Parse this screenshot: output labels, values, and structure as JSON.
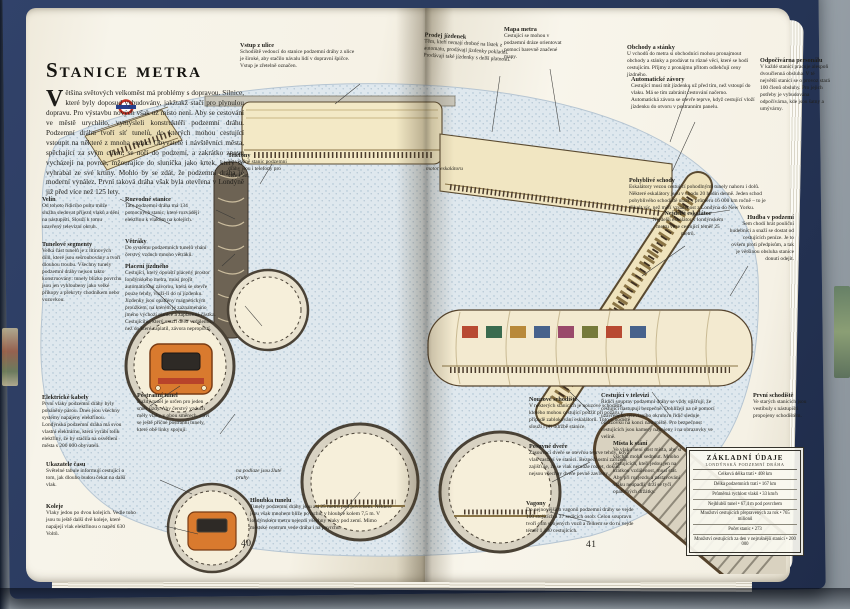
{
  "book": {
    "title": "Stanice metra",
    "intro": "Většina světových velkoměst má problémy s dopravou. Silnice, které byly doposud vybudovány, jakžtakž stačí pro plynulou dopravu. Pro výstavbu nových však už místo není. Aby se cestování ve městě urychlilo, vymysleli konstruktéři podzemní dráhu. Podzemní dráhu tvoří síť tunelů, do kterých mohou cestující vstoupit na některé z mnoha stanic. Obyvatelé i návštěvníci města, spěchající za svým cílem, se noří do podzemí, a zakrátko znovu vycházejí na povrch, mžourajíce do sluníčka jako krtek, který se vyhrabal ze své krtiny. Mohlo by se zdát, že podzemní dráha je moderní vynález. První taková dráha však byla otevřena v Londýně již před více než 125 lety.",
    "page_left": "40",
    "page_right": "41"
  },
  "annotations": {
    "vstup_z_ulice": {
      "heading": "Vstup z ulice",
      "body": "Schodiště vedoucí do stanice podzemní dráhy z ulice je široké, aby stačilo návalu lidí v dopravní špičce. Vstup je zřetelně označen."
    },
    "prodej_jizdenek": {
      "heading": "Prodej jízdenek",
      "body": "Těm, kteří nemají drobné na lístek z automatu, prodávají jízdenky pokladní. Prodávají také jízdenky s delší platností."
    },
    "mapa_metra": {
      "heading": "Mapa metra",
      "body": "Cestující se mohou v podzemní dráze orientovat pomocí barevně značené mapy."
    },
    "obchody_a_stanky": {
      "heading": "Obchody a stánky",
      "body": "U vchodů do metra si obchodníci mohou pronajmout obchody a stánky a prodávat tu různé věci, které se hodí cestujícím. Příjmy z pronájmu přitom odlehčují ceny jízdného."
    },
    "automaticke_zavory": {
      "heading": "Automatické závory",
      "body": "Cestující musí mít jízdenku už před tím, než vstoupí do vlaku. Má se tím zabránit cestování načerno. Automatická závora se otevře teprve, když cestující vloží jízdenku do otvoru v postranním panelu."
    },
    "odpocivarna_personalu": {
      "heading": "Odpočívárna personálu",
      "body": "V každé stanici pracuje alespoň dvoučlenná obsluha. V té největší stanici se o provoz stará 100 členů obsluhy. Pro jejich potřeby je vybudována odpočívárna, kde jsou šatny a umývárny."
    },
    "telefony": {
      "heading": "Telefony",
      "body": "Ve většině stanic podzemní dráhy jsou i telefony pro veřejnost."
    },
    "velin": {
      "heading": "Velín",
      "body": "Od tohoto řídicího pultu může služba sledovat příjezd vlaků a dění na nástupišti. Slouží k tomu uzavřený televizní okruh."
    },
    "rozvodne_stanice": {
      "heading": "Rozvodné stanice",
      "body": "Tato podzemní dráha má 134 pomocných stanic, které rozvádějí elektřinu k vlakům na kolejích."
    },
    "vetraky": {
      "heading": "Větráky",
      "body": "Do systému podzemních tunelů vhání čerstvý vzduch mnoho větráků."
    },
    "tunelove_segmenty": {
      "heading": "Tunelové segmenty",
      "body": "Velká část tunelů je z litinových dílů, které jsou sešroubovány a tvoří dlouhou troubu. Všechny tunely podzemní dráhy nejsou takto konstruovány: tunely blízko povrchu jsou jen vyhloubeny jako velké příkopy a překryty chodníkem nebo vozovkou."
    },
    "placeni_jizdneho": {
      "heading": "Placení jízdného",
      "body": "Cestující, který opouští placený prostor londýnského metra, musí projít automatickou závorou, která se otevře pouze tehdy, vloží-li do ní jízdenku. Jízdenky jsou opatřeny magnetickým proužkem, na kterém je zaznamenáno jméno výchozí stanice a zaplacená částka. Cestujícího, který urazil delší vzdálenost, než do které zaplatil, závora nepropustí."
    },
    "pohyblive_schody": {
      "heading": "Pohyblivé schody",
      "body": "Eskalátory vezou cestující pohodlnými tunely nahoru i dolů. Některé eskalátory jsou v chodu 20 hodin denně. Jeden schod pohyblivého schodiště urazí v průměru 16 000 km ročně – to je třikrát víc, než měří vzdálenost z Londýna do New Yorku."
    },
    "nejdelsi_eskalator": {
      "heading": "Nejdelší eskalátor",
      "body": "Nejdelší eskalátor v londýnském metru veze cestující téměř 25 metrů."
    },
    "hudba_v_podzemi": {
      "heading": "Hudba v podzemí",
      "body": "Sem chodí hrát pouliční hudebníci a snaží se dostat od cestujících peníze. Je to ovšem proti předpisům, a tak je většinou obsluha stanice donutí odejít."
    },
    "elektricke_kabely": {
      "heading": "Elektrické kabely",
      "body": "První vlaky podzemní dráhy byly poháněny párou. Dnes jsou všechny systémy napájeny elektřinou. Londýnská podzemní dráha má svou vlastní elektrárnu, která vyrábí tolik elektřiny, že by stačila na osvětlení města s 200 000 obyvateli."
    },
    "postranni_tunel": {
      "heading": "Postranní tunel",
      "body": "Každý tunel je určen pro jeden směr jízdy. Aby čerstvý vzduch měly vlaky v obou směrech, staví se ještě příčné postranní tunely, které obě linky spojují."
    },
    "ukazatele_casu": {
      "heading": "Ukazatele času",
      "body": "Světelné tabule informují cestující o tom, jak dlouho budou čekat na další vlak."
    },
    "koleje": {
      "heading": "Koleje",
      "body": "Vlaky jedou po dvou kolejích. Vedle toho jsou tu ještě další dvě koleje, které napájejí vlak elektřinou o napětí 630 Voltů."
    },
    "hloubka_tunelu": {
      "heading": "Hloubka tunelu",
      "body": "Tunely podzemní dráhy jsou asi 25 metrů pod povrchem. Některé jsou však mnohem blíže povrchu, v hloubce kolem 7,5 m. V londýnském metru nejezdí všechny vlaky pod zemí. Mimo městské centrum vede dráha i na povrchu."
    },
    "nouzove_schodiste": {
      "heading": "Nouzové schodiště",
      "body": "V některých stanicích je nouzové schodiště, kterého mohou cestující použít při požáru v případě zablokování eskalátorů. Toto schodiště slouží i při údržbě stanice."
    },
    "posuvne_dvere": {
      "heading": "Posuvné dveře",
      "body": "Zasouvací dveře se otevřou teprve tehdy, když vlak zastaví ve stanici. Bezpečnostní zařízení zajišťuje, že se vlak nemůže rozjet, dokud nejsou všechny dveře pevně zavřeny."
    },
    "cestujici_v_televizi": {
      "heading": "Cestující v televizi",
      "body": "Řidiči souprav podzemní dráhy se vždy ujišťují, že cestující nastupují bezpečně. Dohlížejí na ně pomocí uzavřeného televizního okruhu a řidič sleduje obrazovku na konci nástupiště. Pro bezpečnost cestujících jsou kamery napojeny i na obrazovky ve velíně."
    },
    "mista_k_stani": {
      "heading": "Místa k stání",
      "body": "Ve vlaku není dost místa, aby si všichni mohli sednout. Mnoho cestujících, kteří jedou jen na krátkou vzdálenost, musí stát. Aby při rozjezdu a zastavování vlaku neupadli, drží se tyčí opatřených držátky."
    },
    "vagony": {
      "heading": "Vagony",
      "body": "Do nejnovějších vagonů podzemní dráhy se vejde 100 stojících a 37 sedících osob. Celou soupravu tvoří osm spojených vozů a celkem se do ní vejde téměř 1 100 cestujících."
    },
    "prvni_schodiste": {
      "heading": "První schodiště",
      "body": "Ve starých stanicích jsou vestibuly s nástupišti propojeny schodištěm."
    }
  },
  "captions": {
    "motor_eskalatoru": "motor eskalátoru",
    "zlute_pruhy": "na podlaze jsou žluté pruhy"
  },
  "facts": {
    "title": "ZÁKLADNÍ ÚDAJE",
    "subtitle": "LONDÝNSKÁ PODZEMNÍ DRÁHA",
    "rows": [
      "Celková délka tratí • 408 km",
      "Délka podzemních tratí • 167 km",
      "Průměrná rychlost vlaků • 33 km/h",
      "Nejhlubší tunel • 67,4 m pod povrchem",
      "Množství cestujících přepravených za rok • 765 milionů",
      "Počet stanic • 273",
      "Množství cestujících za den v nejrušnější stanici • 200 000"
    ]
  },
  "colors": {
    "cover_navy": "#2a3a5e",
    "page_cream": "#f6f2e6",
    "ground_stipple": "#a8bfd0",
    "hall_cream": "#f3e9c6",
    "train_orange": "#d97a2e"
  }
}
